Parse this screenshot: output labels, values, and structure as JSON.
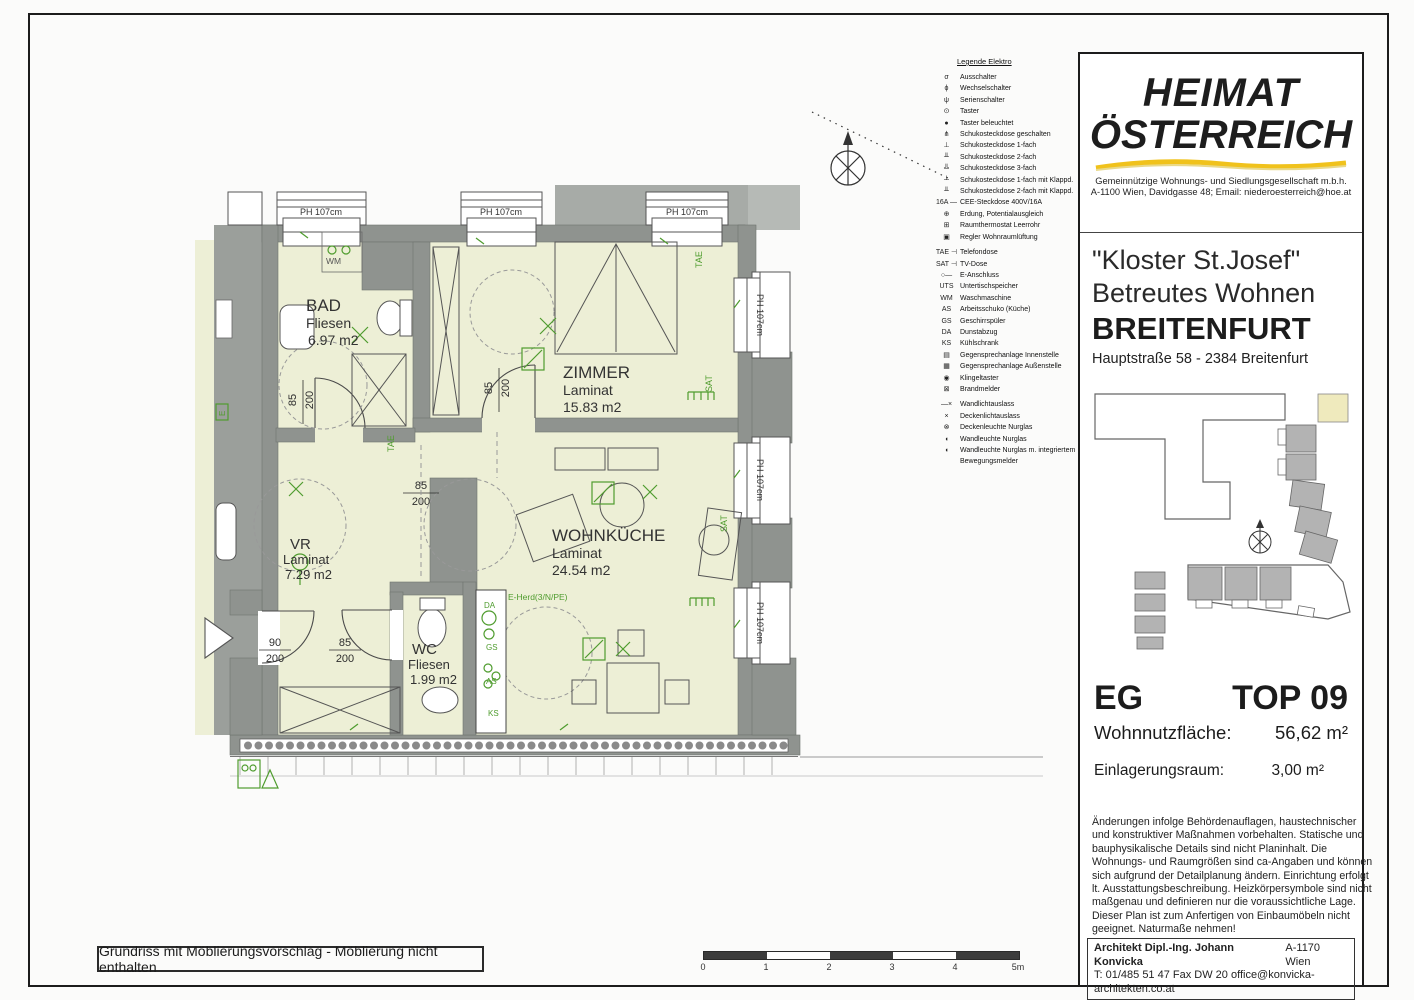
{
  "colors": {
    "wall_gray": "#8f938f",
    "exterior_gray": "#b6bab6",
    "room_fill": "#edefd6",
    "symbol_green": "#4f9c2e",
    "accent_yellow": "#f0c21c",
    "highlight_unit": "#efeabd"
  },
  "legend": {
    "title": "Legende Elektro",
    "items": [
      {
        "icon": "σ",
        "label": "Ausschalter"
      },
      {
        "icon": "ϕ",
        "label": "Wechselschalter"
      },
      {
        "icon": "ψ",
        "label": "Serienschalter"
      },
      {
        "icon": "⊙",
        "label": "Taster"
      },
      {
        "icon": "●",
        "label": "Taster beleuchtet"
      },
      {
        "icon": "⋔",
        "label": "Schukosteckdose geschalten"
      },
      {
        "icon": "⊥",
        "label": "Schukosteckdose 1-fach"
      },
      {
        "icon": "╨",
        "label": "Schukosteckdose 2-fach"
      },
      {
        "icon": "╩",
        "label": "Schukosteckdose 3-fach"
      },
      {
        "icon": "┴",
        "label": "Schukosteckdose 1-fach mit Klappd."
      },
      {
        "icon": "╨",
        "label": "Schukosteckdose 2-fach mit Klappd."
      },
      {
        "icon": "16A —",
        "label": "CEE-Steckdose 400V/16A"
      },
      {
        "icon": "⊕",
        "label": "Erdung, Potentialausgleich"
      },
      {
        "icon": "⊞",
        "label": "Raumthermostat Leerrohr"
      },
      {
        "icon": "▣",
        "label": "Regler Wohnraumlüftung"
      },
      {
        "icon": "TAE ⊣",
        "label": "Telefondose"
      },
      {
        "icon": "SAT ⊣",
        "label": "TV-Dose"
      },
      {
        "icon": "○—",
        "label": "E-Anschluss"
      },
      {
        "icon": "UTS",
        "label": "Untertischspeicher"
      },
      {
        "icon": "WM",
        "label": "Waschmaschine"
      },
      {
        "icon": "AS",
        "label": "Arbeitsschuko (Küche)"
      },
      {
        "icon": "GS",
        "label": "Geschirrspüler"
      },
      {
        "icon": "DA",
        "label": "Dunstabzug"
      },
      {
        "icon": "KS",
        "label": "Kühlschrank"
      },
      {
        "icon": "▤",
        "label": "Gegensprechanlage Innenstelle"
      },
      {
        "icon": "▦",
        "label": "Gegensprechanlage Außenstelle"
      },
      {
        "icon": "◉",
        "label": "Klingeltaster"
      },
      {
        "icon": "⊠",
        "label": "Brandmelder"
      },
      {
        "icon": "—×",
        "label": "Wandlichtauslass"
      },
      {
        "icon": "×",
        "label": "Deckenlichtauslass"
      },
      {
        "icon": "⊗",
        "label": "Deckenleuchte Nurglas"
      },
      {
        "icon": "◖",
        "label": "Wandleuchte Nurglas"
      },
      {
        "icon": "◖",
        "label": "Wandleuchte Nurglas m. integriertem Bewegungsmelder"
      }
    ]
  },
  "plan": {
    "caption": "Grundriss mit Möblierungsvorschlag - Möblierung nicht enthalten",
    "window_label": "PH 107cm",
    "rooms": [
      {
        "name": "BAD",
        "floor": "Fliesen",
        "area": "6.97 m2"
      },
      {
        "name": "ZIMMER",
        "floor": "Laminat",
        "area": "15.83 m2"
      },
      {
        "name": "VR",
        "floor": "Laminat",
        "area": "7.29 m2"
      },
      {
        "name": "WOHNKÜCHE",
        "floor": "Laminat",
        "area": "24.54 m2"
      },
      {
        "name": "WC",
        "floor": "Fliesen",
        "area": "1.99 m2"
      }
    ],
    "dims": {
      "d85": "85",
      "d90": "90",
      "d200": "200"
    },
    "tags": {
      "tae": "TAE",
      "sat": "SAT",
      "wm": "WM",
      "e": "E",
      "eherd": "E-Herd(3/N/PE)",
      "da": "DA",
      "gs": "GS",
      "as": "AS",
      "ks": "KS"
    }
  },
  "scalebar": {
    "labels": [
      "0",
      "1",
      "2",
      "3",
      "4",
      "5m"
    ]
  },
  "titleblock": {
    "brand_line1": "HEIMAT",
    "brand_line2": "ÖSTERREICH",
    "brand_sub1": "Gemeinnützige Wohnungs- und Siedlungsgesellschaft m.b.h.",
    "brand_sub2": "A-1100 Wien, Davidgasse 48; Email: niederoesterreich@hoe.at",
    "project_line1": "\"Kloster St.Josef\"",
    "project_line2": "Betreutes Wohnen",
    "project_line3": "BREITENFURT",
    "project_line4": "Hauptstraße 58 - 2384 Breitenfurt",
    "unit_floor": "EG",
    "unit_top": "TOP 09",
    "area_label": "Wohnnutzfläche:",
    "area_value": "56,62 m²",
    "storage_label": "Einlagerungsraum:",
    "storage_value": "3,00 m²",
    "disclaimer": "Änderungen infolge Behördenauflagen, haustechnischer und konstruktiver Maßnahmen vorbehalten. Statische und bauphysikalische Details sind nicht Planinhalt. Die Wohnungs- und Raumgrößen sind ca-Angaben und können sich aufgrund der Detailplanung ändern. Einrichtung erfolgt lt. Ausstattungsbeschreibung. Heizkörpersymbole sind nicht maßgenau und definieren nur die voraussichtliche Lage. Dieser Plan ist zum Anfertigen von Einbaumöbeln nicht geeignet. Naturmaße nehmen!",
    "architect_name": "Architekt Dipl.-Ing. Johann Konvicka",
    "architect_city": "A-1170 Wien",
    "architect_contact": "T: 01/485 51 47 Fax DW 20  office@konvicka-architekten.co.at"
  }
}
